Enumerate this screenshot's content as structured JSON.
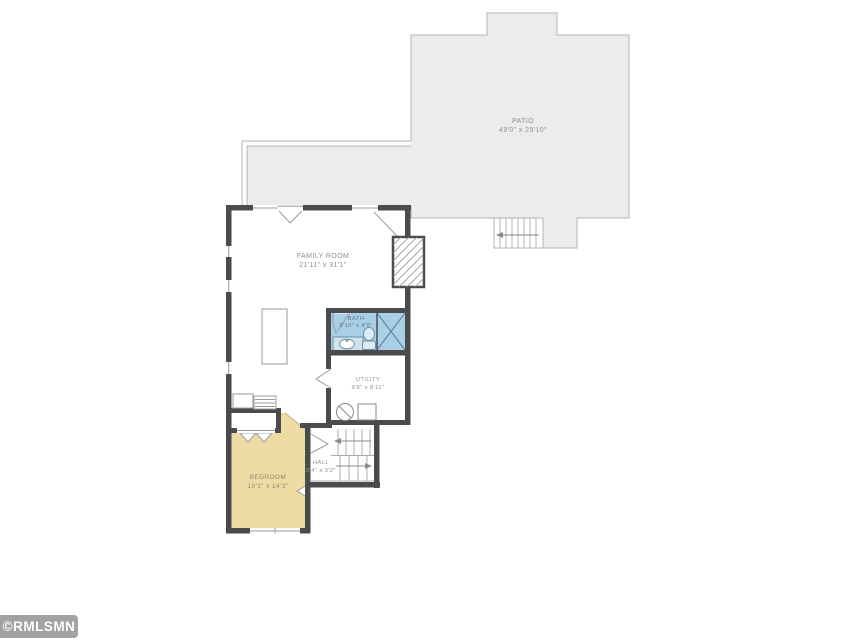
{
  "plan": {
    "title": "Floor plan",
    "rooms": {
      "patio": {
        "name": "PATIO",
        "dims": "49'0\" x 29'10\""
      },
      "family_room": {
        "name": "FAMILY ROOM",
        "dims": "21'11\" x 31'1\""
      },
      "bath": {
        "name": "BATH",
        "dims": "9'10\" x 4'9\""
      },
      "utility": {
        "name": "UTILITY",
        "dims": "9'6\" x 8'11\""
      },
      "hall": {
        "name": "HALL",
        "dims": "8'4\" x 3'2\""
      },
      "bedroom": {
        "name": "BEDROOM",
        "dims": "10'1\" x 14'3\""
      }
    },
    "colors": {
      "patio_fill": "#ececec",
      "patio_line": "#b5b5b5",
      "bath_fill": "#a7d0e6",
      "bedroom_fill": "#efdca4",
      "wall": "#4b4b4e",
      "thin_line": "#9b9b9b",
      "label_text": "#8f8f8f",
      "watermark_bg": "#a2a2a2"
    },
    "watermark": "©RMLSMN"
  }
}
